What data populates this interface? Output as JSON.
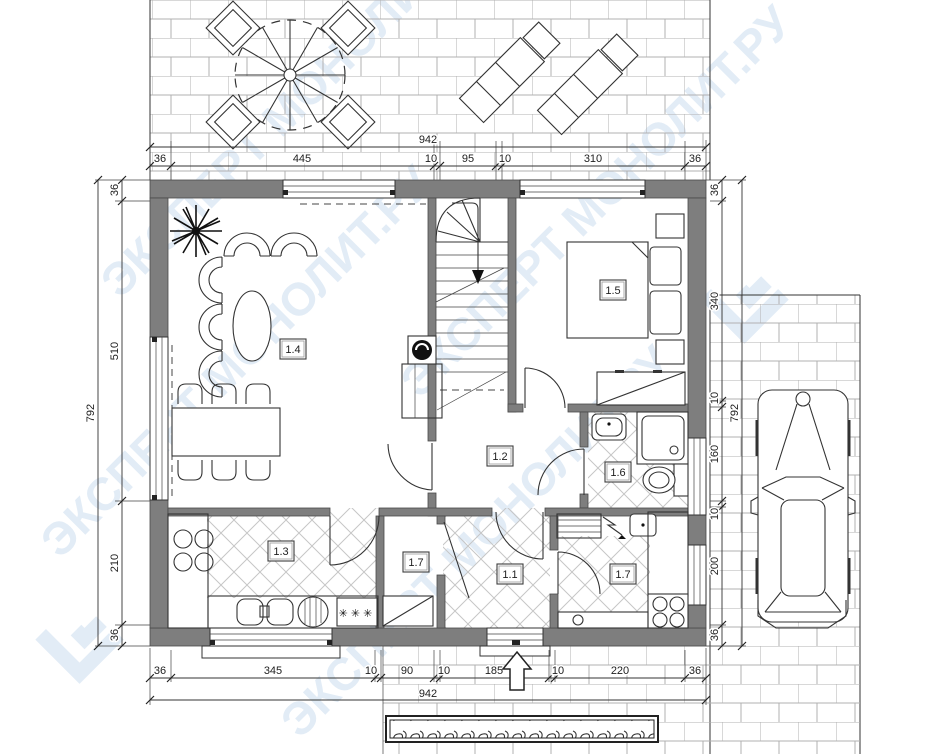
{
  "watermark": {
    "text": "ЭКСПЕРТ МОНОЛИТ.РУ",
    "color": "#e2ecf6"
  },
  "rooms": {
    "entry": {
      "label": "1.1"
    },
    "hall": {
      "label": "1.2"
    },
    "kitchen": {
      "label": "1.3"
    },
    "living": {
      "label": "1.4"
    },
    "bedroom": {
      "label": "1.5"
    },
    "bath": {
      "label": "1.6"
    },
    "store_left": {
      "label": "1.7"
    },
    "store_right": {
      "label": "1.7"
    }
  },
  "dimensions": {
    "top": {
      "overall": "942",
      "segments": [
        "36",
        "445",
        "10",
        "95",
        "10",
        "310",
        "36"
      ]
    },
    "bottom": {
      "overall": "942",
      "segments": [
        "36",
        "345",
        "10",
        "90",
        "10",
        "185",
        "10",
        "220",
        "36"
      ]
    },
    "left": {
      "overall": "792",
      "segments": [
        "36",
        "510",
        "210",
        "36"
      ]
    },
    "right": {
      "overall": "792",
      "segments": [
        "36",
        "340",
        "10",
        "160",
        "10",
        "200",
        "36"
      ]
    }
  },
  "symbols": {
    "fridge": "✳✳✳"
  },
  "colors": {
    "wall": "#7e7e7e",
    "line": "#333333",
    "paving": "#b1b1b1",
    "floor_hatch": "#c6c6c6"
  }
}
